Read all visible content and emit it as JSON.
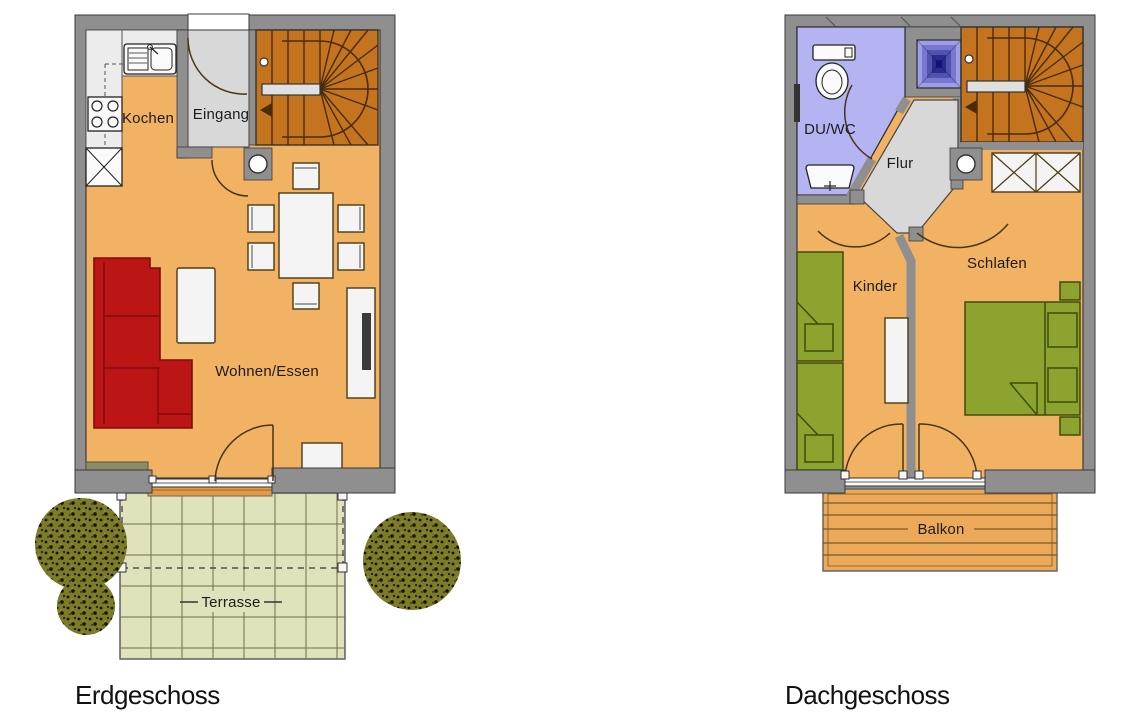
{
  "document": {
    "kind": "floor-plan-drawing",
    "background": "#ffffff"
  },
  "colors": {
    "wall": "#8f8f8f",
    "floor_orange": "#f2b263",
    "hall_gray": "#d8d8d8",
    "stairs_brown": "#c4731f",
    "sofa_red": "#bc1515",
    "terrace_green": "#dfe2ba",
    "tree_olive": "#7b7b2a",
    "bath_purple": "#b4b4f2",
    "shower_blue": "#151578",
    "bed_green": "#8ca32f",
    "balcony_orange": "#eda95a",
    "furniture_white": "#f4f4f4"
  },
  "floors": {
    "ground": {
      "title": "Erdgeschoss",
      "rooms": {
        "kitchen": {
          "label": "Kochen"
        },
        "entrance": {
          "label": "Eingang"
        },
        "living_dining": {
          "label": "Wohnen/Essen"
        },
        "terrace": {
          "label": "Terrasse"
        }
      },
      "fixtures": [
        "kitchen-sink",
        "stove",
        "tall-cabinet",
        "spiral-stairs",
        "entrance-door",
        "dining-table",
        "six-chairs",
        "corner-sofa",
        "coffee-table",
        "tv-sideboard",
        "cabinet",
        "window-sill",
        "terrace-door",
        "terrace-step",
        "pergola-posts",
        "three-trees"
      ]
    },
    "attic": {
      "title": "Dachgeschoss",
      "rooms": {
        "bath": {
          "label": "DU/WC"
        },
        "hall": {
          "label": "Flur"
        },
        "child": {
          "label": "Kinder"
        },
        "bedroom": {
          "label": "Schlafen"
        },
        "balcony": {
          "label": "Balkon"
        }
      },
      "fixtures": [
        "toilet",
        "wash-basin",
        "shower-pan",
        "spiral-stairs",
        "wardrobe",
        "two-single-beds",
        "shelf",
        "double-bed",
        "two-pillows",
        "two-nightstands",
        "balcony-doors"
      ]
    }
  }
}
